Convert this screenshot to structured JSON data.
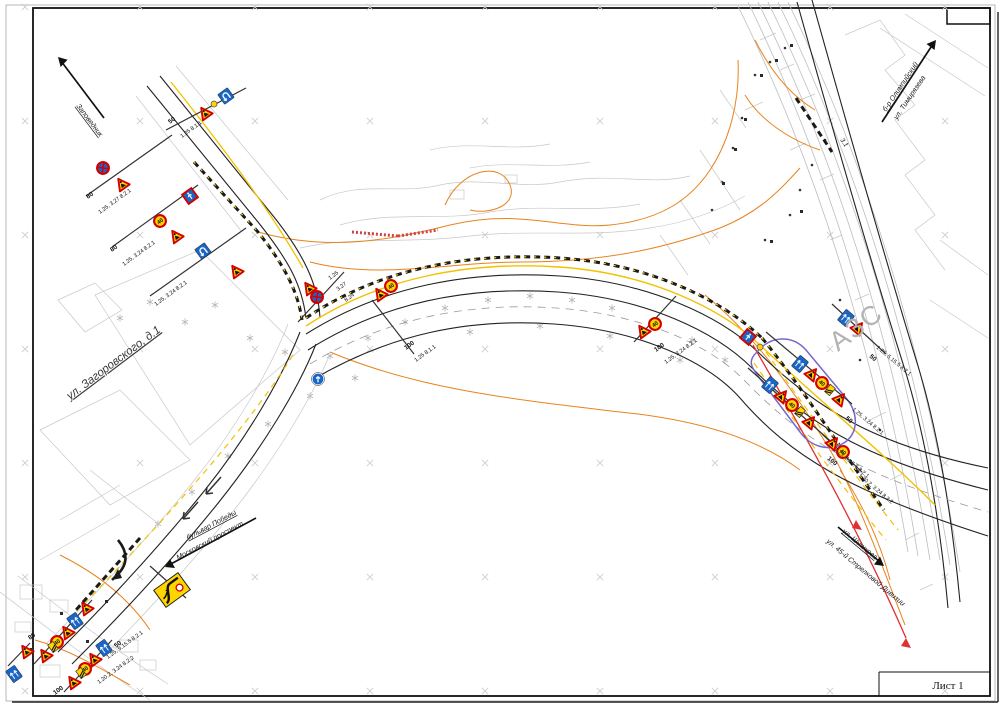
{
  "document": {
    "sheet_label": "Лист 1"
  },
  "streets": {
    "zagorovskogo": "ул. Загоровского, д.1",
    "azs": "АЗС"
  },
  "directions": {
    "nw": "Заповедник",
    "ne_line1": "б-р Олимпийский",
    "ne_line2": "ул. Тимирязева",
    "sw_line1": "бульвар Победы",
    "sw_line2": "Московский проспект",
    "se_line1": "ул. Шишкова",
    "se_line2": "ул. 45-й Стрелковой Дивизии"
  },
  "signs": {
    "speed_value": "40"
  },
  "sign_codes": {
    "c_no_stop": "1.25, 3.27 8.2.1",
    "c_speed": "1.25, 3.24 8.2.1",
    "c_lanes": "1.25, 5.15.5 8.2.1",
    "c_narrow": "1.20.2, 3.24 8.2.2",
    "c_simple": "1.25 8.1.1",
    "c_327": "3.27",
    "c_824": "8.24",
    "c_125": "1.25",
    "c_31": "3.1"
  },
  "stations": {
    "s50": "50",
    "s80": "80",
    "s100": "100"
  },
  "colors": {
    "utility_orange": "#e8831d",
    "temp_marking_yellow": "#ffd400",
    "sign_blue": "#1766c8",
    "sign_red": "#d40000",
    "route_red": "#e03030",
    "route_purple": "#7766cc",
    "cadastre_gray": "#c8c8c8"
  }
}
